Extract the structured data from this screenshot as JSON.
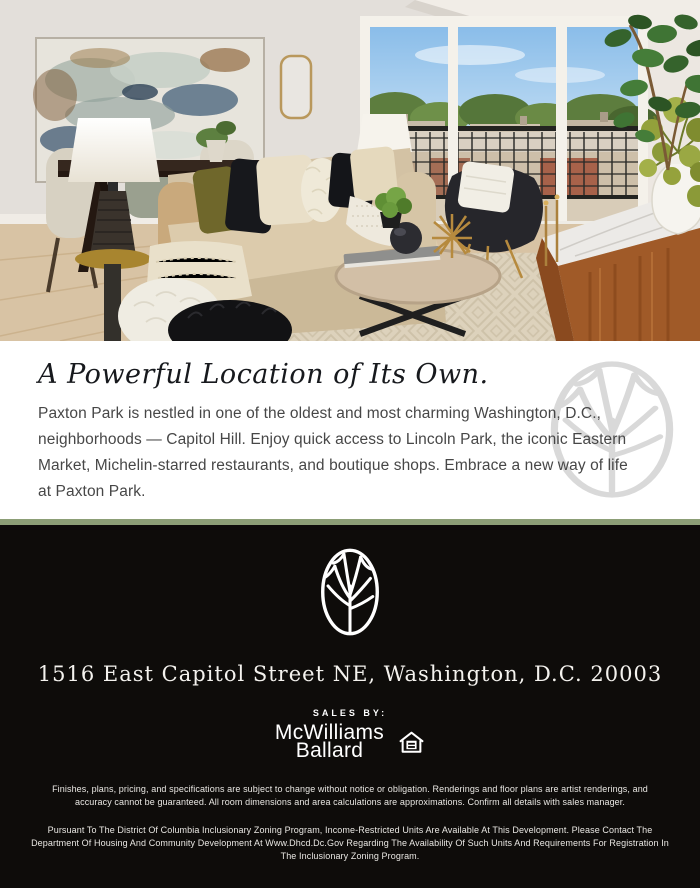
{
  "hero": {
    "alt": "Bright staged living room: dining nook with abstract painting and white lamp, beige sofa with olive, black and cream pillows, round wood coffee table with black sphere and book, black accent chair with gold legs, balcony sliding door with black mesh railing and rowhouse rooftops view, wood console with marble top, fiddle-leaf fig and green pom-pom florals"
  },
  "intro": {
    "headline": "A Powerful Location of Its Own.",
    "paragraph_lines": [
      "Paxton Park is nestled in one of the oldest and most charming Washington, D.C.,",
      "neighborhoods — Capitol Hill. Enjoy quick access to Lincoln Park, the iconic Eastern",
      "Market, Michelin-starred restaurants, and boutique shops. Embrace a new way of life",
      "at Paxton Park."
    ]
  },
  "divider": {
    "color": "#8c9e76"
  },
  "footer": {
    "background": "#0e0c0a",
    "address": "1516 East Capitol Street NE, Washington, D.C. 20003",
    "sales_by_label": "SALES BY:",
    "brand": {
      "line1": "McWilliams",
      "line2": "Ballard"
    },
    "disclaimer_1_lines": [
      "Finishes, plans, pricing, and specifications are subject to change without notice or obligation. Renderings and floor plans are artist renderings, and",
      "accuracy cannot be guaranteed. All room dimensions and area calculations are approximations. Confirm all details with sales manager."
    ],
    "disclaimer_2_lines": [
      "Pursuant To The District Of Columbia Inclusionary Zoning Program, Income-Restricted Units Are Available At This Development. Please Contact The",
      "Department Of Housing And Community Development At Www.Dhcd.Dc.Gov Regarding The Availability Of Such Units And Requirements For Registration In",
      "The Inclusionary Zoning Program."
    ]
  }
}
